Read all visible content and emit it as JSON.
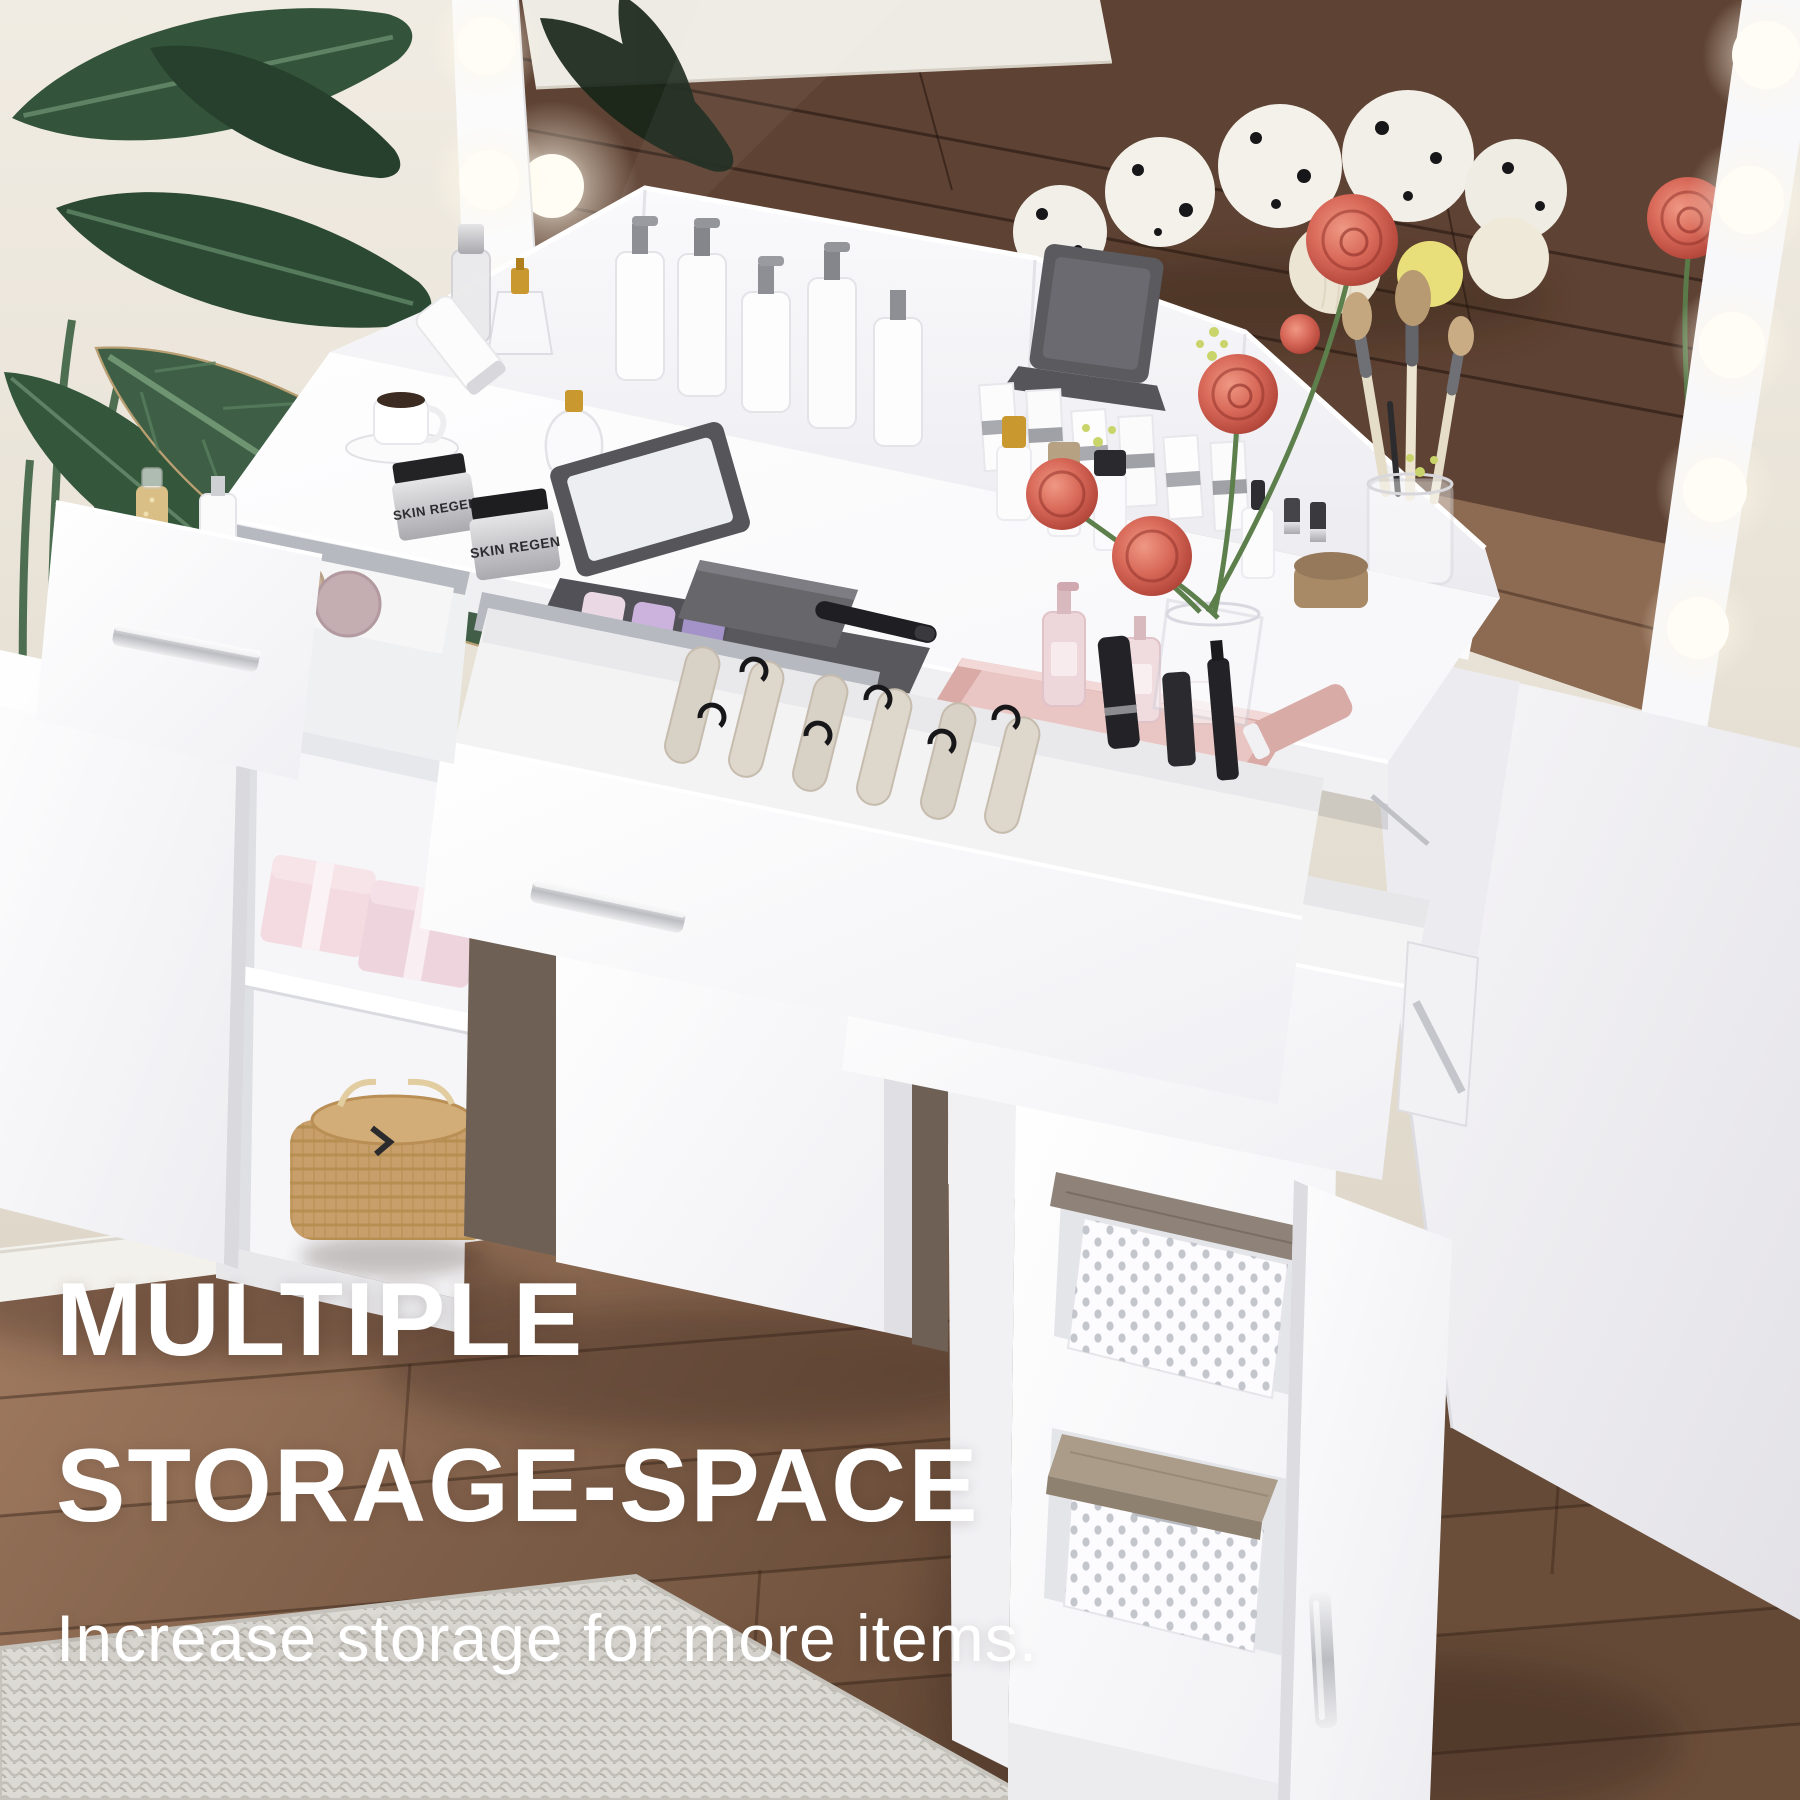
{
  "overlay": {
    "headline_line1": "MULTIPLE",
    "headline_line2": "STORAGE-SPACE",
    "subtitle": "Increase storage for more items."
  },
  "product_labels": {
    "cream_jar_front": "SKIN REGEN",
    "cream_jar_back": "SKIN REGEN",
    "supplement_jar": "SUNDALE"
  },
  "scene_notes": {
    "mirror_lights_left_count": 3,
    "mirror_lights_right_count": 5
  },
  "colors": {
    "headline_text": "#ffffff",
    "wall": "#ece7dd",
    "floor_wood": "#8a6753",
    "mirror_reflection_wood": "#5e4233",
    "vanity_white": "#ffffff",
    "handle_silver": "#c7c8cc",
    "rose": "#d96a5a",
    "plant_green": "#33543a",
    "gift_box_pink": "#f3dbe1",
    "wicker_basket": "#c89f6a",
    "tray_rose_gold": "#d9aaa6",
    "sundale_accent_orange": "#e06a22"
  }
}
